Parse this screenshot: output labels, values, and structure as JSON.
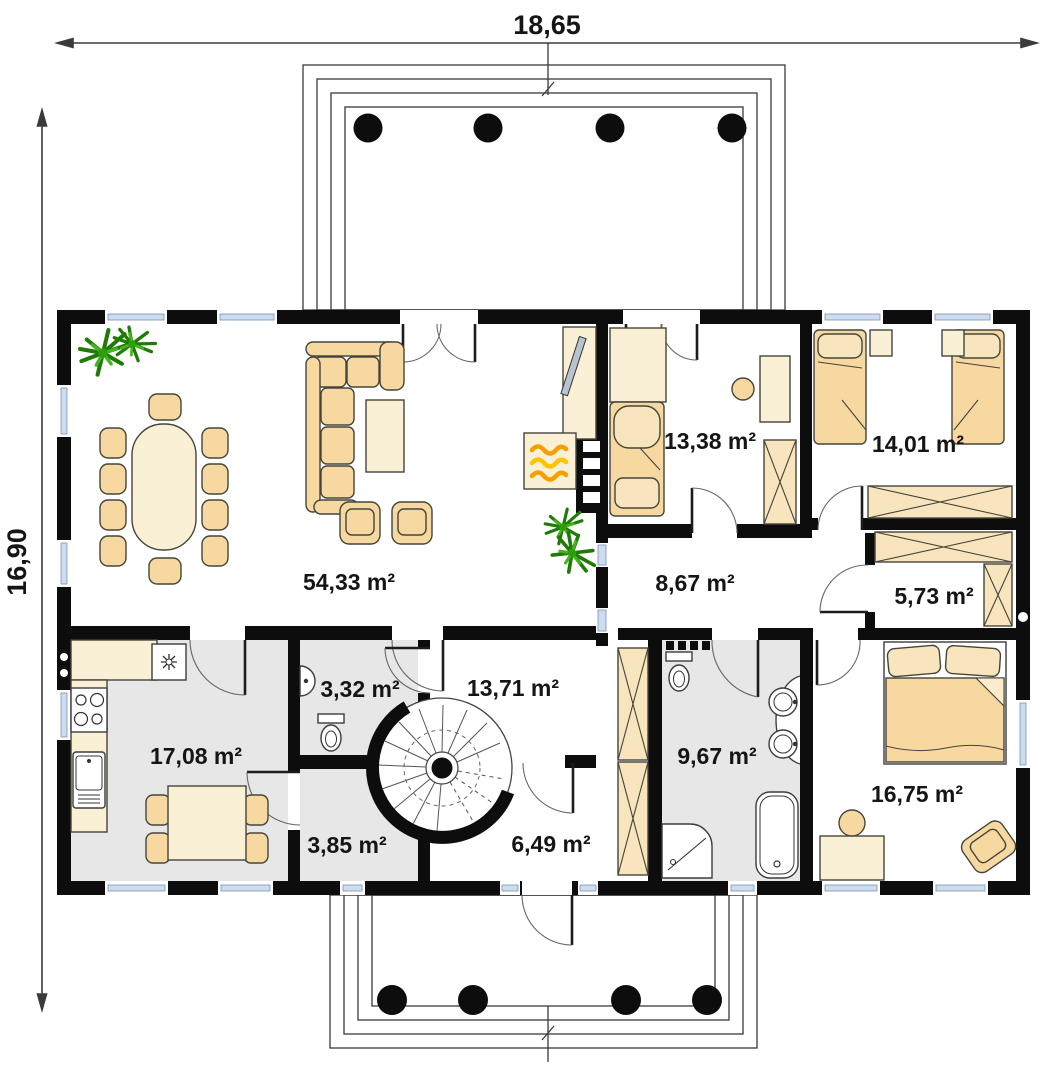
{
  "page": {
    "type": "house-ground-floor-plan"
  },
  "dims": {
    "width": "18,65",
    "height": "16,90"
  },
  "rooms": {
    "living": {
      "name": "living-dining-room",
      "area": "54,33 m²"
    },
    "kitchen": {
      "name": "kitchen",
      "area": "17,08 m²"
    },
    "wc": {
      "name": "toilet",
      "area": "3,32 m²"
    },
    "stair_hall": {
      "name": "stair-hall",
      "area": "13,71 m²"
    },
    "hall": {
      "name": "hallway",
      "area": "8,67 m²"
    },
    "room_a": {
      "name": "bedroom-top-center",
      "area": "13,38 m²"
    },
    "room_b": {
      "name": "bedroom-top-right",
      "area": "14,01 m²"
    },
    "closet": {
      "name": "walk-in-closet",
      "area": "5,73 m²"
    },
    "mudroom": {
      "name": "utility-room",
      "area": "3,85 m²"
    },
    "corridor": {
      "name": "corridor",
      "area": "6,49 m²"
    },
    "bathroom": {
      "name": "bathroom",
      "area": "9,67 m²"
    },
    "bedroom": {
      "name": "bedroom-bottom-right",
      "area": "16,75 m²"
    }
  },
  "colors": {
    "wall": "#0d0d0d",
    "furniture_tan": "#f6d8a0",
    "furniture_cream": "#faf0d6",
    "floor_gray": "#e7e7e7",
    "window_glass": "#cdddf1",
    "plant_green": "#2f9e0c",
    "flame_orange": "#f59f00"
  }
}
